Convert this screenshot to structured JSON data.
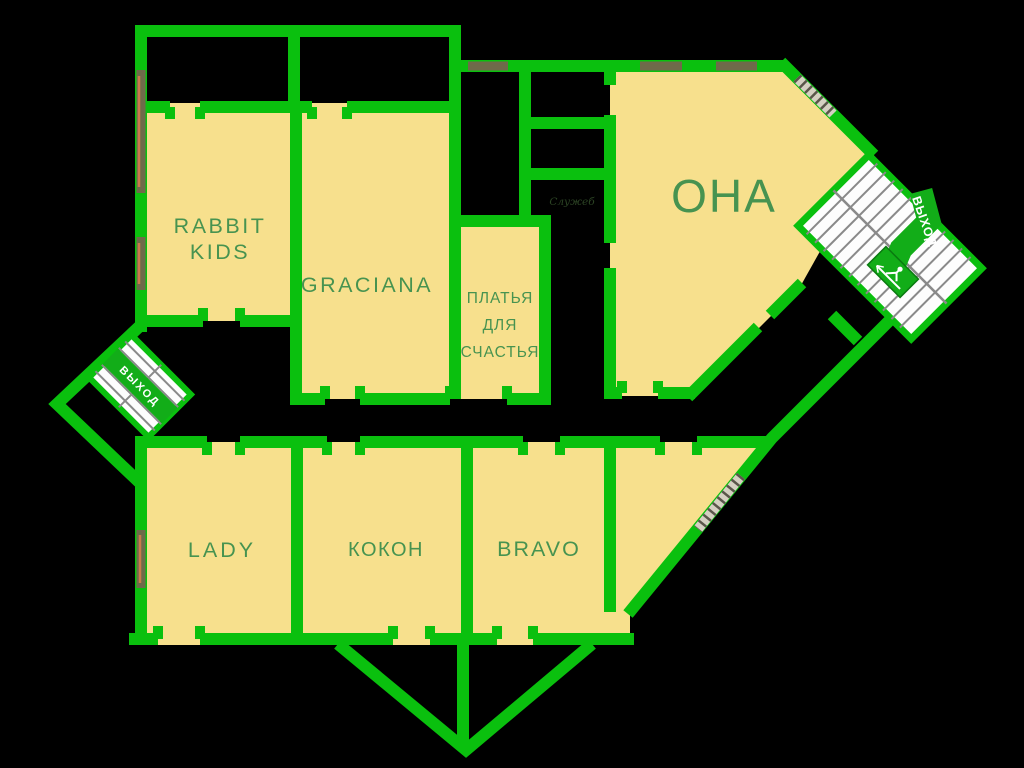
{
  "plan": {
    "type": "retail-floor-plan",
    "background": "#000000"
  },
  "colors": {
    "wall_green": "#0ac00e",
    "room_yellow": "#f7e08d",
    "label_green": "#479350",
    "exit_sign_green": "#12ad18",
    "stair_fill": "#fdfdfd",
    "stair_step_gray": "#8a8a8a",
    "window_olive": "#6f6a4a",
    "window_accent": "#c97a4a",
    "background": "#000000"
  },
  "rooms": {
    "rabbit_kids": {
      "lines": [
        "RABBIT",
        "KIDS"
      ]
    },
    "graciana": {
      "label": "GRACIANA"
    },
    "platya_dlya_schastya": {
      "lines": [
        "ПЛАТЬЯ",
        "ДЛЯ",
        "СЧАСТЬЯ"
      ]
    },
    "ona": {
      "label": "ОНА"
    },
    "lady": {
      "label": "LADY"
    },
    "kokon": {
      "label": "КОКОН"
    },
    "bravo": {
      "label": "BRAVO"
    }
  },
  "signs": {
    "exit_top_right": "ВЫХОД",
    "exit_left": "ВЫХОД",
    "service_label": "Служеб"
  }
}
